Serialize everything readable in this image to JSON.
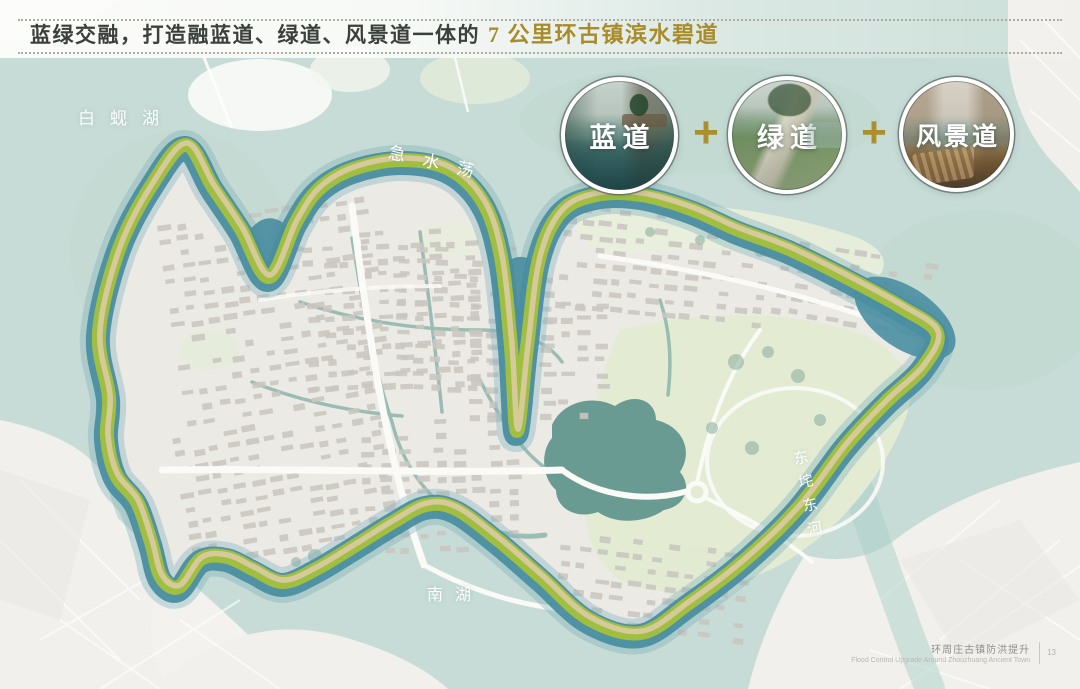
{
  "header": {
    "title_main": "蓝绿交融，打造融蓝道、绿道、风景道一体的",
    "title_accent": "7 公里环古镇滨水碧道"
  },
  "legend": {
    "plus_sign": "+",
    "items": [
      {
        "label": "蓝道"
      },
      {
        "label": "绿道"
      },
      {
        "label": "风景道"
      }
    ]
  },
  "map_labels": {
    "baixian_lake": "白蚬湖",
    "jishui_dang": "急水荡",
    "dongcha_donghe": "东垞东河",
    "south_lake": "南湖"
  },
  "footer": {
    "cn": "环周庄古镇防洪提升",
    "en": "Flood Control Upgrade Around Zhouzhuang Ancient Town",
    "page": "13"
  },
  "colors": {
    "accent_gold": "#a98c28",
    "band_blue": "#4a8ea1",
    "band_green": "#a4c23c",
    "band_tan": "#d9caa0",
    "water_light": "#c7dcd6",
    "town_base": "#eceae5"
  }
}
